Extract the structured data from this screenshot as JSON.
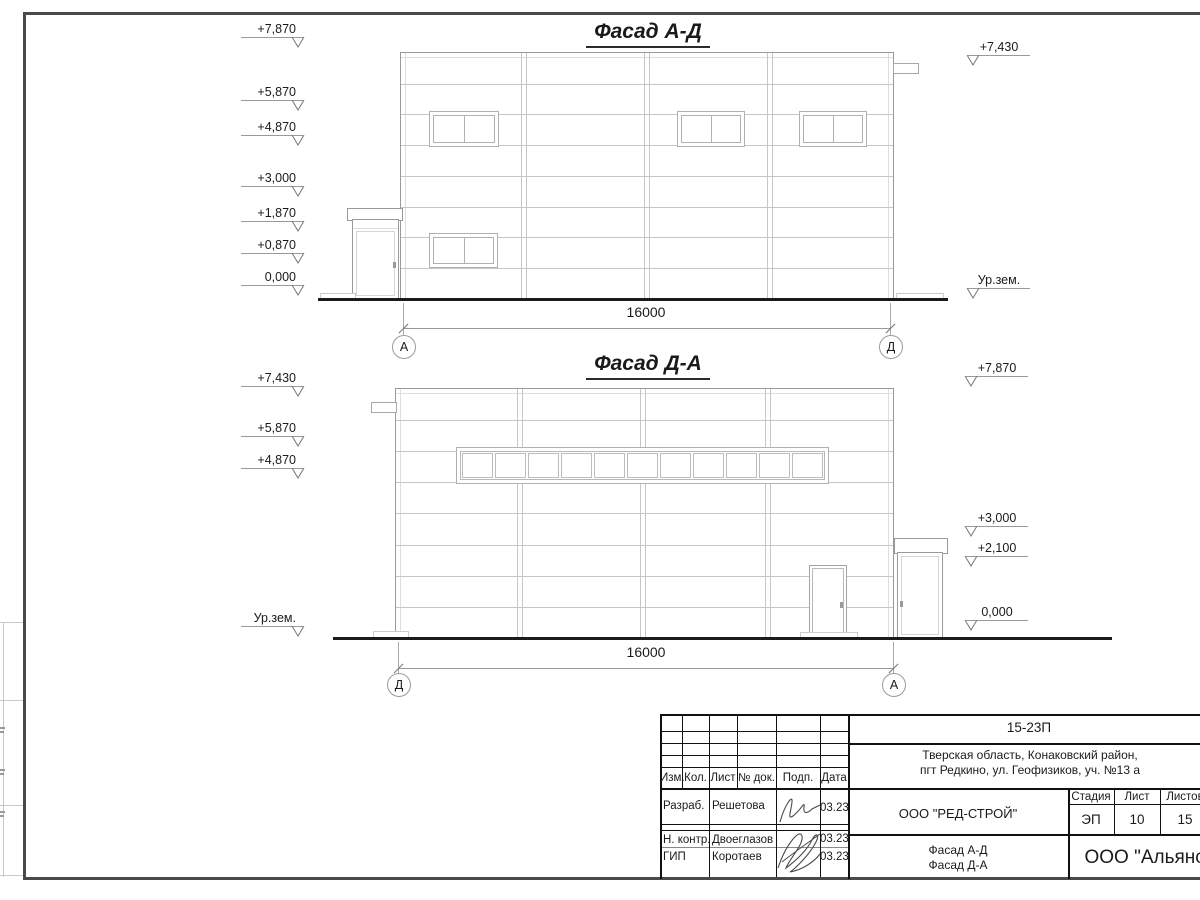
{
  "facade1": {
    "title": "Фасад А-Д",
    "dimension": "16000",
    "axis_left": "А",
    "axis_right": "Д",
    "marks_left": [
      "+7,870",
      "+5,870",
      "+4,870",
      "+3,000",
      "+1,870",
      "+0,870",
      "0,000"
    ],
    "marks_right": [
      "+7,430",
      "Ур.зем."
    ]
  },
  "facade2": {
    "title": "Фасад Д-А",
    "dimension": "16000",
    "axis_left": "Д",
    "axis_right": "А",
    "marks_left": [
      "+7,430",
      "+5,870",
      "+4,870",
      "Ур.зем."
    ],
    "marks_right": [
      "+7,870",
      "+3,000",
      "+2,100",
      "0,000"
    ]
  },
  "titleblock": {
    "doc_number": "15-23П",
    "address1": "Тверская область, Конаковский район,",
    "address2": "пгт Редкино, ул. Геофизиков, уч. №13 а",
    "designer_org": "ООО \"РЕД-СТРОЙ\"",
    "sheet_name1": "Фасад А-Д",
    "sheet_name2": "Фасад Д-А",
    "company": "ООО \"Альянс\"",
    "stage_label": "Стадия",
    "list_label": "Лист",
    "lists_label": "Листов",
    "stage": "ЭП",
    "list_no": "10",
    "lists_total": "15",
    "col_izm": "Изм.",
    "col_kol": "Кол.",
    "col_list": "Лист",
    "col_doc": "№ док.",
    "col_sign": "Подп.",
    "col_date": "Дата",
    "row1_role": "Разраб.",
    "row1_name": "Решетова",
    "row1_date": "03.23",
    "row2_role": "Н. контр.",
    "row2_name": "Двоеглазов",
    "row2_date": "03.23",
    "row3_role": "ГИП",
    "row3_name": "Коротаев",
    "row3_date": "03.23"
  }
}
